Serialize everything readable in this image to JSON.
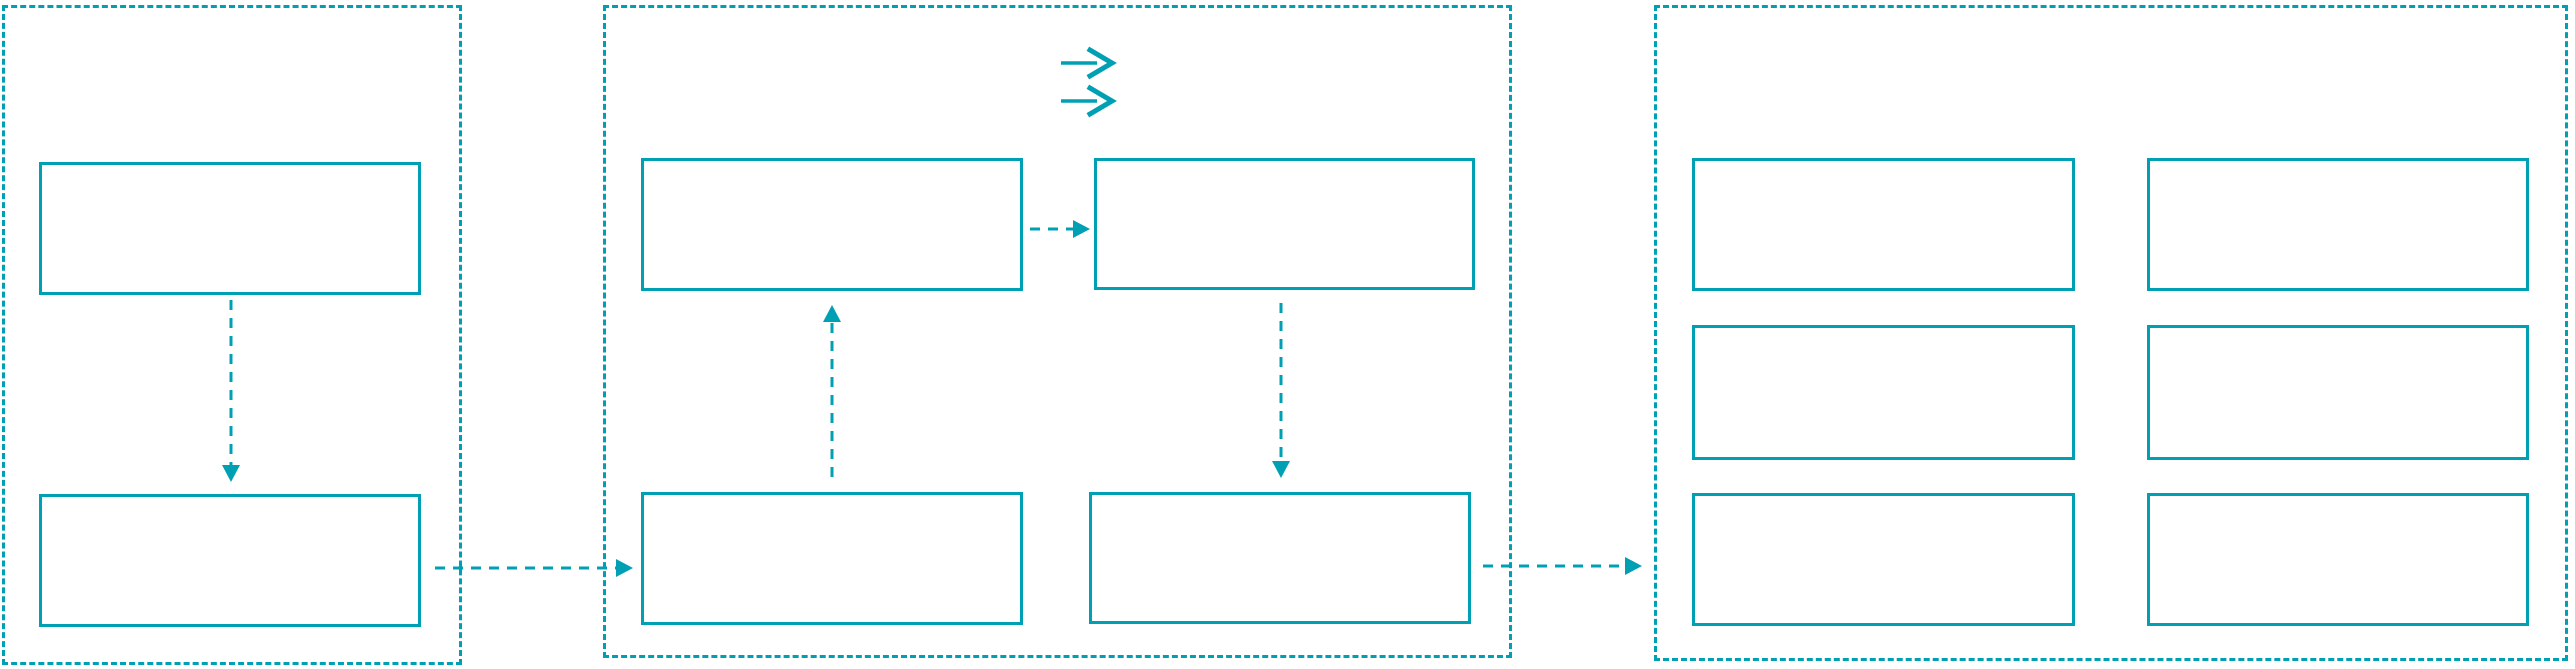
{
  "diagram": {
    "type": "flowchart",
    "background_color": "#ffffff",
    "accent_color": "#00a0b4",
    "panels": [
      {
        "id": "left-group",
        "border_style": "dashed",
        "box_count": 2,
        "boxes_have_text": false
      },
      {
        "id": "middle-group",
        "border_style": "dashed",
        "box_count": 4,
        "boxes_have_text": false
      },
      {
        "id": "right-group",
        "border_style": "dashed",
        "box_count": 6,
        "boxes_have_text": false
      }
    ],
    "icons": [
      {
        "name": "double-arrow-icon",
        "glyph": "two stacked right arrows",
        "location": "top of middle group"
      }
    ],
    "arrows": [
      {
        "name": "left-top-to-bottom-arrow",
        "style": "dashed",
        "direction": "down"
      },
      {
        "name": "left-to-middle-arrow",
        "style": "dashed",
        "direction": "right"
      },
      {
        "name": "middle-bottomleft-to-topleft-arrow",
        "style": "dashed",
        "direction": "up"
      },
      {
        "name": "middle-topleft-to-topright-arrow",
        "style": "dashed",
        "direction": "right"
      },
      {
        "name": "middle-topright-to-bottomright-arrow",
        "style": "dashed",
        "direction": "down"
      },
      {
        "name": "middle-to-right-arrow",
        "style": "dashed",
        "direction": "right"
      }
    ]
  }
}
